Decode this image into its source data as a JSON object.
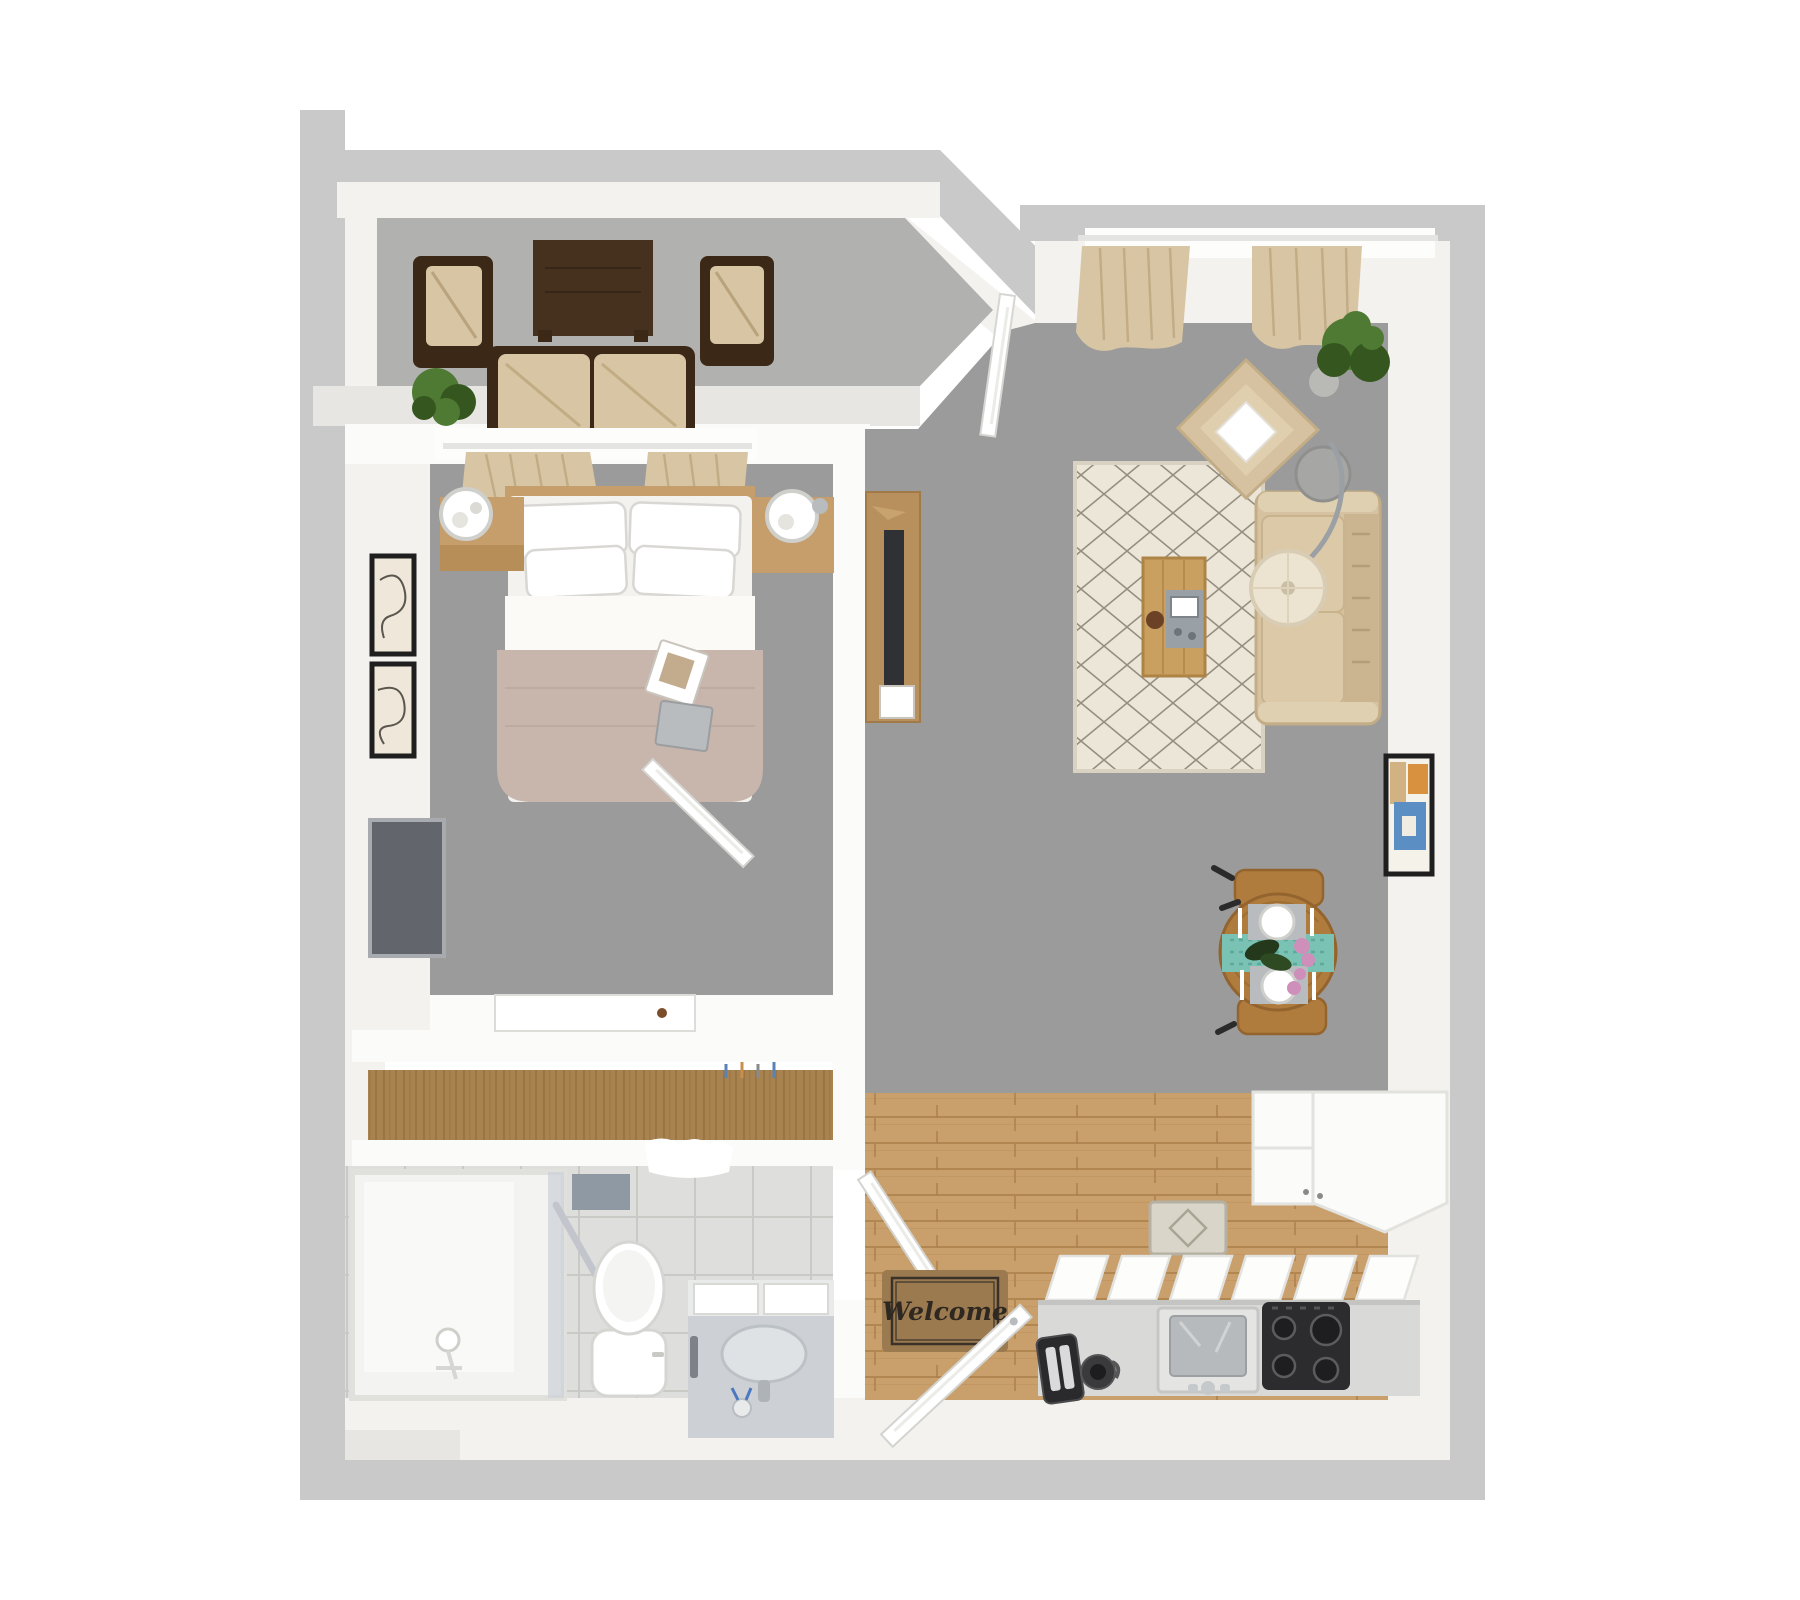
{
  "entry": {
    "welcome_mat_text": "Welcome"
  },
  "palette": {
    "wall_gray": "#c9c9c9",
    "wall_light": "#e7e6e3",
    "wall_face": "#f3f2ee",
    "interior_wall": "#fbfbf9",
    "carpet": "#9b9b9b",
    "balcony_floor": "#b1b1b0",
    "wood_floor": "#c99f6c",
    "wood_floor_dark": "#ab7f49",
    "closet_wood": "#a8834f",
    "closet_wood_dark": "#8c6a3b",
    "tile_floor": "#dededc",
    "tile_line": "#c9c9c6",
    "textile_beige": "#d8c5a3",
    "textile_beige_dark": "#c4ae86",
    "wicker_brown": "#3b2817",
    "dark_table": "#46301e",
    "blanket_taupe": "#c8b5ab",
    "rug_cream": "#ece6d9",
    "rug_line": "#7f7868",
    "runner_teal": "#79c2b4",
    "flower_pink": "#cf8fbb",
    "plant_green": "#4e7a33",
    "plant_green_dark": "#35571f",
    "steel_gray": "#b7babc",
    "stove_black": "#2c2c2e",
    "mat_brown": "#9b7a50",
    "mat_text": "#2e2821",
    "tv_gray": "#62666c",
    "coffee_wood": "#c9a05f",
    "dining_wood": "#b07c3e",
    "frame_black": "#1f1f1f",
    "art_blue": "#5b8fc4",
    "art_orange": "#d8913f",
    "art_tan": "#d2b183",
    "lamp_cream": "#ece3d0"
  },
  "rooms": {
    "balcony": {
      "items": [
        "wicker-armchair-left",
        "wicker-armchair-right",
        "dark-wood-table",
        "wicker-loveseat",
        "potted-plant"
      ]
    },
    "bedroom": {
      "items": [
        "window-curtains",
        "headboard-shelf",
        "double-bed",
        "pillows",
        "throw-blanket",
        "magazines",
        "nightstand-left",
        "nightstand-right",
        "sphere-lamp-left",
        "sphere-lamp-right",
        "framed-art-top",
        "framed-art-bottom",
        "wall-tv",
        "white-desk",
        "bedroom-door"
      ]
    },
    "closet": {
      "items": [
        "wood-shelf",
        "hangers"
      ]
    },
    "bathroom": {
      "items": [
        "walk-in-shower",
        "grab-bar",
        "shower-head",
        "toilet",
        "vanity-sink",
        "toothbrush-cup",
        "towels",
        "wall-hook-panel",
        "bathroom-door"
      ]
    },
    "hallway": {
      "items": [
        "welcome-mat",
        "front-door"
      ]
    },
    "kitchen": {
      "items": [
        "base-cabinets",
        "kitchen-sink",
        "cooktop",
        "toaster",
        "coffee-maker",
        "upper-cabinets",
        "kitchen-rug"
      ]
    },
    "living_room": {
      "items": [
        "window-curtains",
        "french-door",
        "tv-console",
        "console-tv",
        "area-rug",
        "coffee-table",
        "serving-tray",
        "sofa",
        "armchair",
        "throw-pillow",
        "arc-floor-lamp",
        "side-table",
        "potted-plant",
        "dining-table",
        "dining-chair-top",
        "dining-chair-bottom",
        "table-runner",
        "place-settings",
        "flower-centerpiece",
        "wall-art"
      ]
    }
  }
}
